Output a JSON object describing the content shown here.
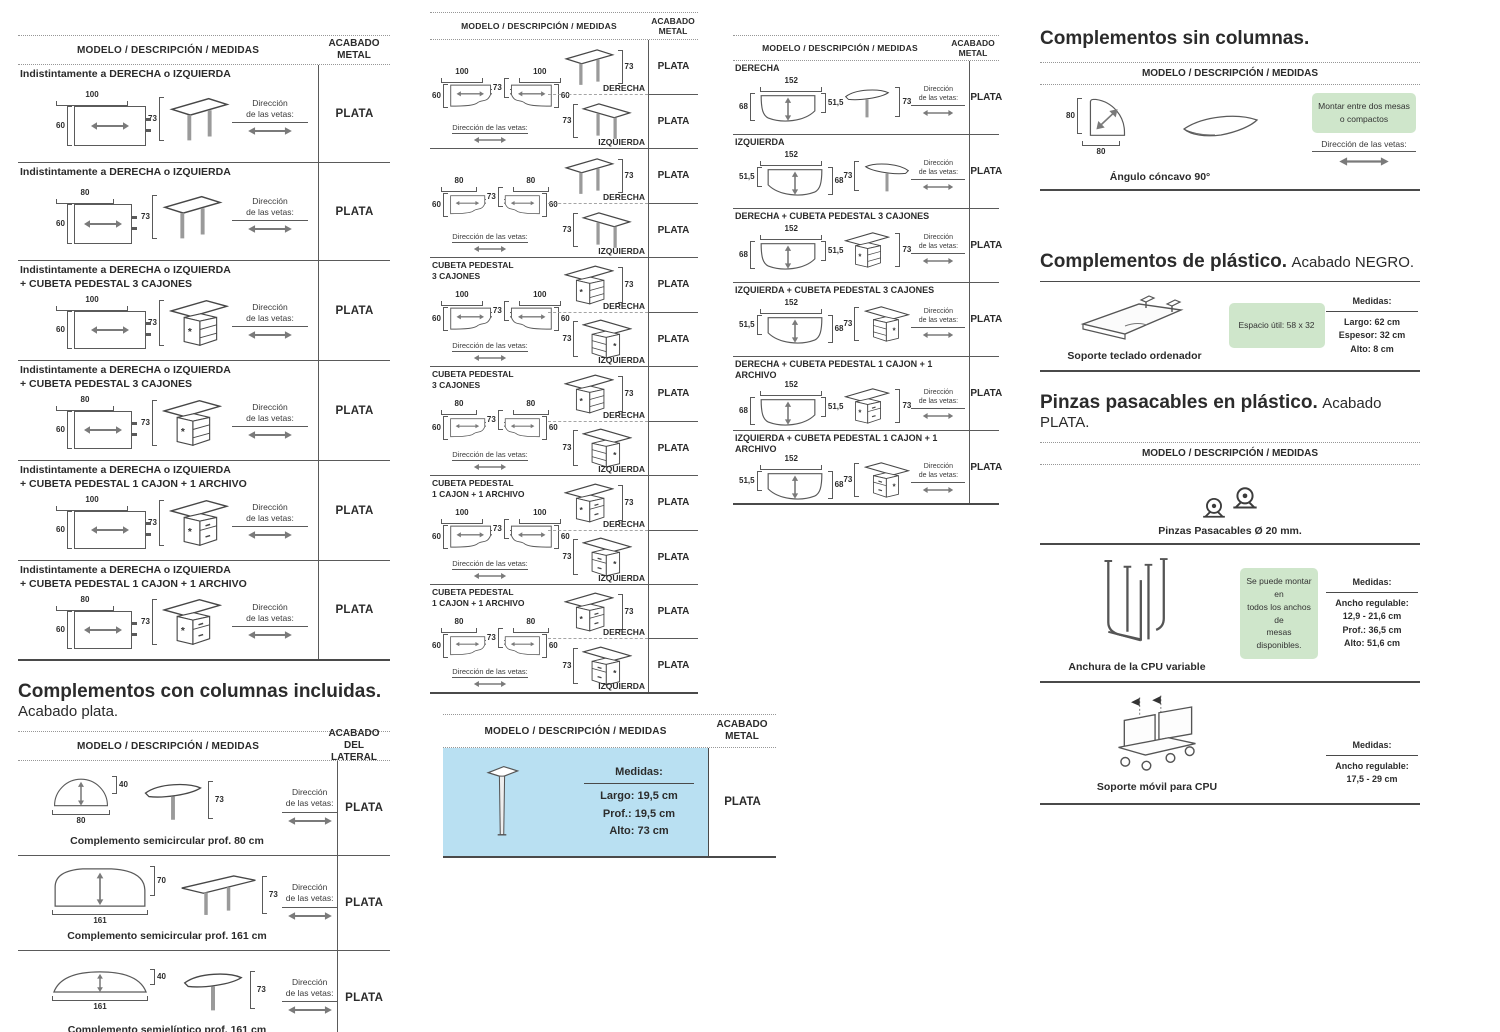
{
  "labels": {
    "header": "MODELO / DESCRIPCIÓN / MEDIDAS",
    "acabado1": "ACABADO",
    "acabado2": "METAL",
    "acabadoL1": "ACABADO DEL",
    "acabadoL2": "LATERAL",
    "vetas1": "Dirección",
    "vetas2": "de las vetas:",
    "vetasline": "Dirección de las vetas:",
    "derecha": "DERECHA",
    "izquierda": "IZQUIERDA",
    "medidas": "Medidas:"
  },
  "col1": {
    "rows1": [
      {
        "t1": "Indistintamente a DERECHA o IZQUIERDA",
        "t2": "",
        "w": "100",
        "d": "60",
        "h": "73",
        "finish": "PLATA"
      },
      {
        "t1": "Indistintamente a DERECHA o IZQUIERDA",
        "t2": "",
        "w": "80",
        "d": "60",
        "h": "73",
        "finish": "PLATA"
      },
      {
        "t1": "Indistintamente a DERECHA o IZQUIERDA",
        "t2": "+ CUBETA PEDESTAL 3 CAJONES",
        "w": "100",
        "d": "60",
        "h": "73",
        "finish": "PLATA"
      },
      {
        "t1": "Indistintamente a DERECHA o IZQUIERDA",
        "t2": "+ CUBETA PEDESTAL 3 CAJONES",
        "w": "80",
        "d": "60",
        "h": "73",
        "finish": "PLATA"
      },
      {
        "t1": "Indistintamente a DERECHA o IZQUIERDA",
        "t2": "+ CUBETA PEDESTAL 1 CAJON + 1 ARCHIVO",
        "w": "100",
        "d": "60",
        "h": "73",
        "finish": "PLATA"
      },
      {
        "t1": "Indistintamente a DERECHA o IZQUIERDA",
        "t2": "+ CUBETA PEDESTAL 1 CAJON + 1 ARCHIVO",
        "w": "80",
        "d": "60",
        "h": "73",
        "finish": "PLATA"
      }
    ],
    "title2": "Complementos con columnas incluidas.",
    "subtitle2": "Acabado plata.",
    "rows2": [
      {
        "name": "Complemento semicircular prof. 80 cm",
        "w": "80",
        "d": "40",
        "h": "73",
        "finish": "PLATA"
      },
      {
        "name": "Complemento semicircular prof. 161 cm",
        "w": "161",
        "d": "70",
        "h": "73",
        "finish": "PLATA"
      },
      {
        "name": "Complemento semielíptico prof. 161 cm",
        "w": "161",
        "d": "40",
        "h": "73",
        "finish": "PLATA"
      }
    ]
  },
  "col2": {
    "blocks": [
      {
        "l1": "",
        "l2": "",
        "w1": "100",
        "w2": "100",
        "d": "60",
        "mid": "73",
        "h": "73",
        "finD": "PLATA",
        "finI": "PLATA"
      },
      {
        "l1": "",
        "l2": "",
        "w1": "80",
        "w2": "80",
        "d": "60",
        "mid": "73",
        "h": "73",
        "finD": "PLATA",
        "finI": "PLATA"
      },
      {
        "l1": "CUBETA PEDESTAL",
        "l2": "3 CAJONES",
        "w1": "100",
        "w2": "100",
        "d": "60",
        "mid": "73",
        "h": "73",
        "finD": "PLATA",
        "finI": "PLATA"
      },
      {
        "l1": "CUBETA PEDESTAL",
        "l2": "3 CAJONES",
        "w1": "80",
        "w2": "80",
        "d": "60",
        "mid": "73",
        "h": "73",
        "finD": "PLATA",
        "finI": "PLATA"
      },
      {
        "l1": "CUBETA PEDESTAL",
        "l2": "1 CAJON + 1 ARCHIVO",
        "w1": "100",
        "w2": "100",
        "d": "60",
        "mid": "73",
        "h": "73",
        "finD": "PLATA",
        "finI": "PLATA"
      },
      {
        "l1": "CUBETA PEDESTAL",
        "l2": "1 CAJON + 1 ARCHIVO",
        "w1": "80",
        "w2": "80",
        "d": "60",
        "mid": "73",
        "h": "73",
        "finD": "PLATA",
        "finI": "PLATA"
      }
    ],
    "leg": {
      "m1": "Largo: 19,5 cm",
      "m2": "Prof.: 19,5 cm",
      "m3": "Alto: 73 cm",
      "finish": "PLATA"
    }
  },
  "col3": {
    "rows": [
      {
        "title": "DERECHA",
        "w": "152",
        "hl": "68",
        "hr": "51,5",
        "h": "73",
        "finish": "PLATA"
      },
      {
        "title": "IZQUIERDA",
        "w": "152",
        "hl": "51,5",
        "hr": "68",
        "h": "73",
        "finish": "PLATA"
      },
      {
        "title": "DERECHA + CUBETA PEDESTAL 3 CAJONES",
        "w": "152",
        "hl": "68",
        "hr": "51,5",
        "h": "73",
        "finish": "PLATA"
      },
      {
        "title": "IZQUIERDA + CUBETA PEDESTAL 3 CAJONES",
        "w": "152",
        "hl": "51,5",
        "hr": "68",
        "h": "73",
        "finish": "PLATA"
      },
      {
        "title": "DERECHA + CUBETA PEDESTAL 1 CAJON + 1 ARCHIVO",
        "w": "152",
        "hl": "68",
        "hr": "51,5",
        "h": "73",
        "finish": "PLATA"
      },
      {
        "title": "IZQUIERDA + CUBETA PEDESTAL 1 CAJON + 1 ARCHIVO",
        "w": "152",
        "hl": "51,5",
        "hr": "68",
        "h": "73",
        "finish": "PLATA"
      }
    ]
  },
  "col4": {
    "s1_title": "Complementos sin columnas.",
    "s1_note_l1": "Montar entre dos mesas",
    "s1_note_l2": "o compactos",
    "s1_caption": "Ángulo cóncavo 90°",
    "s1_w": "80",
    "s1_d": "80",
    "s2_title": "Complementos de plástico.",
    "s2_subtitle": "Acabado NEGRO.",
    "s2_caption": "Soporte teclado ordenador",
    "s2_note": "Espacio útil: 58 x 32",
    "s2_m1": "Largo: 62 cm",
    "s2_m2": "Espesor: 32 cm",
    "s2_m3": "Alto: 8 cm",
    "s3_title": "Pinzas pasacables en plástico.",
    "s3_subtitle": "Acabado PLATA.",
    "s3_caption1": "Pinzas Pasacables  Ø 20 mm.",
    "s3_caption2": "Anchura de la CPU variable",
    "s3_note_l1": "Se puede montar en",
    "s3_note_l2": "todos los anchos de",
    "s3_note_l3": "mesas disponibles.",
    "s3_m1": "Ancho regulable:",
    "s3_m2": "12,9 - 21,6 cm",
    "s3_m3": "Prof.: 36,5 cm",
    "s3_m4": "Alto: 51,6 cm",
    "s3_caption3": "Soporte móvil para CPU",
    "s4_m1": "Ancho regulable:",
    "s4_m2": "17,5 - 29 cm"
  }
}
